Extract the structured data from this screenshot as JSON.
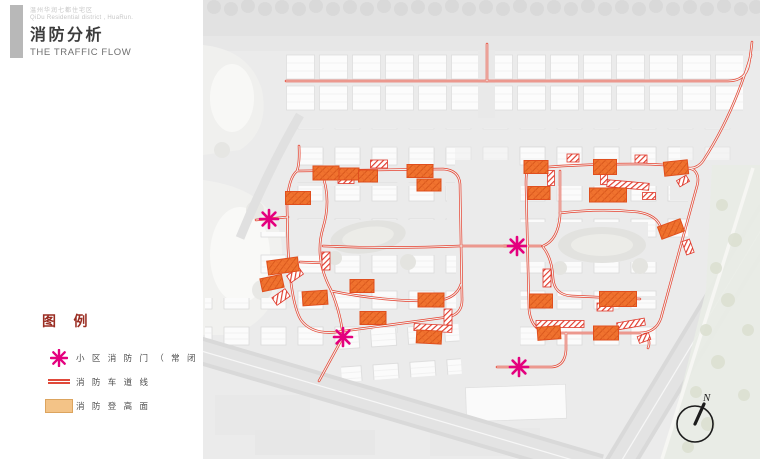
{
  "header": {
    "project_line_zh": "温州华润七都住宅区",
    "project_line_en": "QiDu Residential district , HuaRun.",
    "title": "消防分析",
    "subtitle": "THE TRAFFIC FLOW"
  },
  "legend": {
    "title": "图 例",
    "items": [
      {
        "icon": "fire-gate-asterisk-icon",
        "label": "小 区 消 防 门 （ 常 闭 ）"
      },
      {
        "icon": "fire-lane-double-line-icon",
        "label": "消 防 车 道 线"
      },
      {
        "icon": "fire-platform-swatch-icon",
        "label": "消 防 登 高 面"
      }
    ]
  },
  "map": {
    "compass_label": "N"
  },
  "colors": {
    "route_red": "#e6402e",
    "platform_orange": "#f0722e",
    "gate_magenta": "#e4007e",
    "legend_title_red": "#9a2d22",
    "header_bar_gray": "#b8b8b8"
  }
}
